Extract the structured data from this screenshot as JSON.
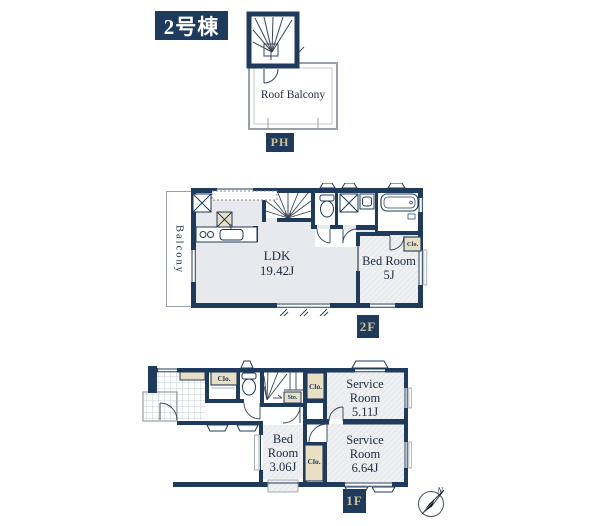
{
  "title": {
    "building": "2号棟"
  },
  "floors": {
    "ph": {
      "badge": "PH",
      "roof_balcony": "Roof Balcony"
    },
    "f2": {
      "badge": "2F",
      "balcony": "Balcony",
      "ldk": {
        "name": "LDK",
        "size": "19.42J"
      },
      "bed": {
        "name": "Bed Room",
        "size": "5J"
      },
      "closet": "Clo."
    },
    "f1": {
      "badge": "1F",
      "service_a": {
        "name": "Service Room",
        "size": "5.11J"
      },
      "service_b": {
        "name": "Service Room",
        "size": "6.64J"
      },
      "bed": {
        "name": "Bed Room",
        "size": "3.06J"
      },
      "closet_entry": "Clo.",
      "closet_hall": "Clo.",
      "closet_bed": "Clo.",
      "storage": "Sto."
    }
  },
  "compass": {
    "north": "N"
  },
  "colors": {
    "wall_navy": "#1e3a5c",
    "badge_bg": "#1e3a5c",
    "badge_text": "#cfc28e",
    "closet_tan": "#e9e0c3",
    "room_gray": "#e7e9ec",
    "thin_line": "#9aa0a8"
  }
}
